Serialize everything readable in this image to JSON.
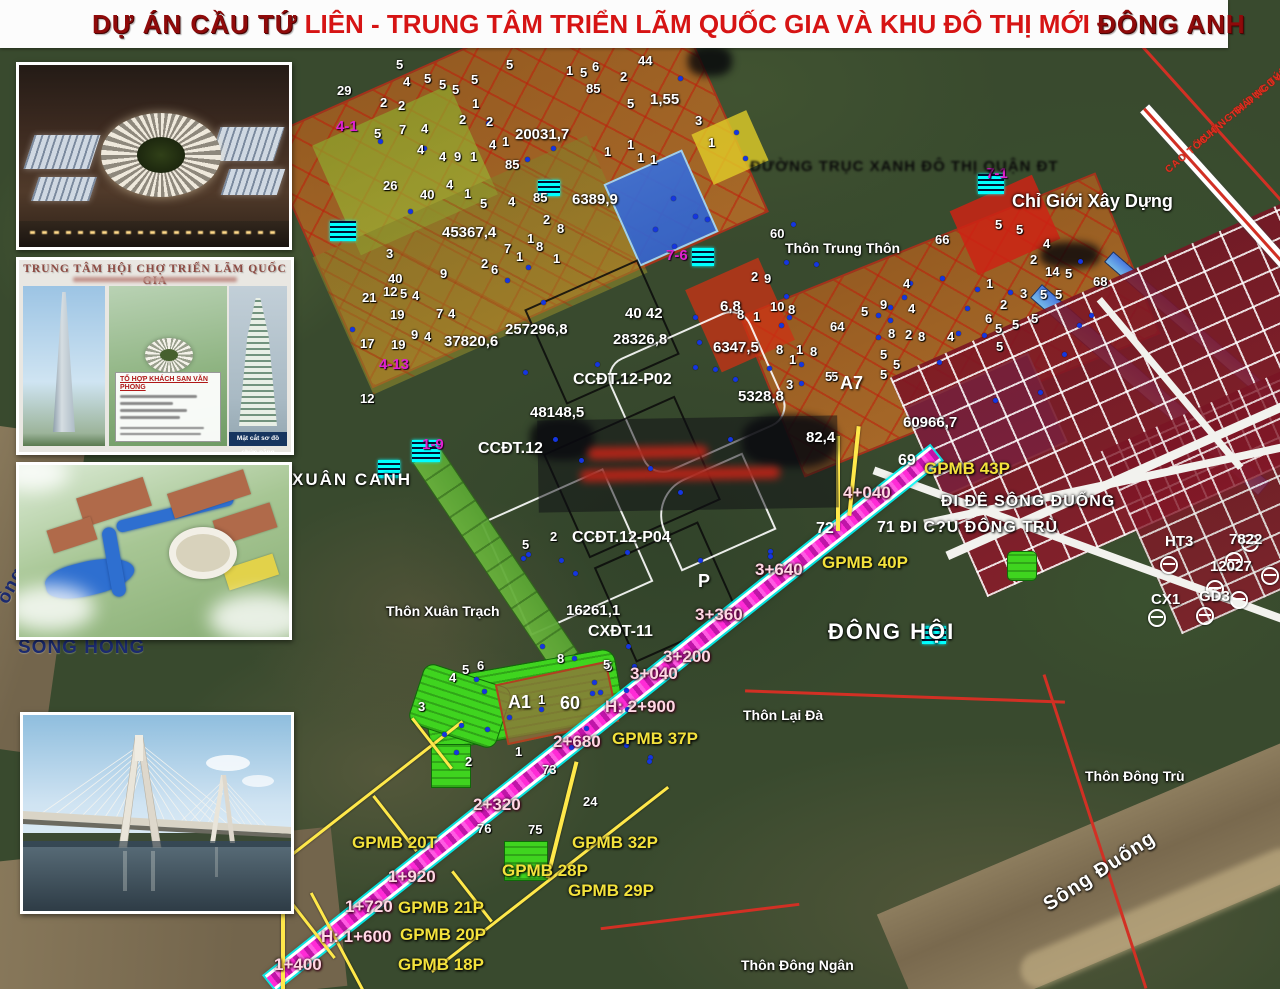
{
  "title": {
    "part1": "DỰ ÁN CẦU TỨ",
    "part2": " LIÊN - TRUNG TÂM TRIỂN LÃM QUỐC GIA VÀ KHU ĐÔ THỊ MỚI ",
    "part3": "ĐÔNG ANH"
  },
  "insets": {
    "exhibition_panel": {
      "header": "TRUNG TÂM HỘI CHỢ TRIỂN LÃM QUỐC GIA",
      "box_title": "TỔ HỢP KHÁCH SẠN VĂN PHÒNG",
      "section_caption": "Mặt cắt sơ đồ chức năng"
    }
  },
  "map": {
    "places": [
      {
        "t": "XUÂN CANH",
        "x": 292,
        "y": 471,
        "s": 17,
        "ls": 2
      },
      {
        "t": "Thôn Xuân Trạch",
        "x": 386,
        "y": 604
      },
      {
        "t": "Thôn Trung Thôn",
        "x": 785,
        "y": 241
      },
      {
        "t": "ĐÔNG HỘI",
        "x": 828,
        "y": 620,
        "s": 22,
        "ls": 2
      },
      {
        "t": "Thôn Lại Đà",
        "x": 743,
        "y": 708
      },
      {
        "t": "Thôn Đông Trù",
        "x": 1085,
        "y": 769
      },
      {
        "t": "Thôn Đông Ngân",
        "x": 741,
        "y": 958
      },
      {
        "t": "Chỉ Giới Xây Dựng",
        "x": 1012,
        "y": 192,
        "s": 18
      },
      {
        "t": "Sông Đuống",
        "x": 1040,
        "y": 898,
        "s": 20,
        "r": -33,
        "ls": 1
      }
    ],
    "river_labels": [
      {
        "t": "SÔNG HỒNG",
        "x": 18,
        "y": 638
      },
      {
        "t": "ồng",
        "x": -6,
        "y": 598,
        "r": -62
      }
    ],
    "gpmb": [
      {
        "t": "GPMB 43P",
        "x": 924,
        "y": 460
      },
      {
        "t": "GPMB 40P",
        "x": 822,
        "y": 554
      },
      {
        "t": "GPMB 37P",
        "x": 612,
        "y": 730
      },
      {
        "t": "GPMB 32P",
        "x": 572,
        "y": 834
      },
      {
        "t": "GPMB 28P",
        "x": 502,
        "y": 862
      },
      {
        "t": "GPMB 29P",
        "x": 568,
        "y": 882
      },
      {
        "t": "GPMB 20T",
        "x": 352,
        "y": 834
      },
      {
        "t": "GPMB 21P",
        "x": 398,
        "y": 899
      },
      {
        "t": "GPMB 20P",
        "x": 400,
        "y": 926
      },
      {
        "t": "GPMB 18P",
        "x": 398,
        "y": 956
      }
    ],
    "chainage": [
      {
        "t": "4+040",
        "x": 843,
        "y": 484
      },
      {
        "t": "3+640",
        "x": 755,
        "y": 561
      },
      {
        "t": "3+360",
        "x": 695,
        "y": 606
      },
      {
        "t": "3+200",
        "x": 663,
        "y": 648
      },
      {
        "t": "3+040",
        "x": 630,
        "y": 665
      },
      {
        "t": "H: 2+900",
        "x": 605,
        "y": 698
      },
      {
        "t": "2+680",
        "x": 553,
        "y": 733
      },
      {
        "t": "2+320",
        "x": 473,
        "y": 796
      },
      {
        "t": "1+920",
        "x": 388,
        "y": 868
      },
      {
        "t": "1+720",
        "x": 345,
        "y": 898
      },
      {
        "t": "H: 1+600",
        "x": 321,
        "y": 928
      },
      {
        "t": "1+400",
        "x": 274,
        "y": 956
      }
    ],
    "area_numbers": [
      {
        "t": "20031,7",
        "x": 515,
        "y": 127
      },
      {
        "t": "6389,9",
        "x": 572,
        "y": 192
      },
      {
        "t": "45367,4",
        "x": 442,
        "y": 225
      },
      {
        "t": "257296,8",
        "x": 505,
        "y": 322
      },
      {
        "t": "37820,6",
        "x": 444,
        "y": 334
      },
      {
        "t": "28326,8",
        "x": 613,
        "y": 332
      },
      {
        "t": "6347,5",
        "x": 713,
        "y": 340
      },
      {
        "t": "5328,8",
        "x": 738,
        "y": 389
      },
      {
        "t": "48148,5",
        "x": 530,
        "y": 405
      },
      {
        "t": "60966,7",
        "x": 903,
        "y": 415
      },
      {
        "t": "82,4",
        "x": 806,
        "y": 430
      },
      {
        "t": "16261,1",
        "x": 566,
        "y": 603
      },
      {
        "t": "1,55",
        "x": 650,
        "y": 92
      },
      {
        "t": "40 42",
        "x": 625,
        "y": 306
      },
      {
        "t": "6,8",
        "x": 720,
        "y": 299
      }
    ],
    "zone_codes": [
      {
        "t": "CCĐT.12-P02",
        "x": 573,
        "y": 372
      },
      {
        "t": "CCĐT.12-P04",
        "x": 572,
        "y": 530
      },
      {
        "t": "CXĐT-11",
        "x": 588,
        "y": 624
      },
      {
        "t": "CCĐT.12",
        "x": 478,
        "y": 441
      },
      {
        "t": "A7",
        "x": 840,
        "y": 374,
        "s": 18
      },
      {
        "t": "A1",
        "x": 508,
        "y": 693,
        "s": 18
      },
      {
        "t": "60",
        "x": 560,
        "y": 694,
        "s": 18
      },
      {
        "t": "P",
        "x": 698,
        "y": 572,
        "s": 18
      }
    ],
    "magenta_codes": [
      {
        "t": "4-1",
        "x": 336,
        "y": 119
      },
      {
        "t": "4-13",
        "x": 379,
        "y": 357
      },
      {
        "t": "1-9",
        "x": 422,
        "y": 437
      },
      {
        "t": "7-1",
        "x": 986,
        "y": 166
      },
      {
        "t": "7-6",
        "x": 666,
        "y": 248
      }
    ],
    "route_numbers": [
      {
        "t": "69",
        "x": 898,
        "y": 453
      },
      {
        "t": "72",
        "x": 816,
        "y": 521
      },
      {
        "t": "71",
        "x": 877,
        "y": 520
      }
    ],
    "road_white": [
      {
        "t": "ĐI ĐÊ SÔNG ĐUỐNG",
        "x": 941,
        "y": 494
      },
      {
        "t": "ĐI C?U ĐÔNG TRÙ",
        "x": 900,
        "y": 520
      }
    ],
    "road_black": [
      {
        "t": "ĐƯỜNG TRỤC XANH ĐÔ THỊ QUẬN ĐT",
        "x": 750,
        "y": 159
      }
    ],
    "red_route": [
      {
        "t": "HƯỚNG ĐI DỤC TÚ",
        "x": 1196,
        "y": 140,
        "r": -40
      },
      {
        "t": "CAO TỐC HN - THÁI NGUYÊN",
        "x": 1164,
        "y": 168,
        "r": -40
      }
    ],
    "survey": [
      {
        "t": "HT3",
        "x": 1165,
        "y": 534
      },
      {
        "t": "7822",
        "x": 1229,
        "y": 532
      },
      {
        "t": "12027",
        "x": 1210,
        "y": 559
      },
      {
        "t": "CX1",
        "x": 1151,
        "y": 592
      },
      {
        "t": "GD3",
        "x": 1199,
        "y": 589
      }
    ],
    "survey_markers": [
      [
        1160,
        556
      ],
      [
        1225,
        552
      ],
      [
        1206,
        580
      ],
      [
        1261,
        567
      ],
      [
        1230,
        591
      ],
      [
        1196,
        607
      ],
      [
        1148,
        609
      ],
      [
        1241,
        534
      ]
    ],
    "small_numbers": [
      [
        337,
        84,
        "29"
      ],
      [
        396,
        58,
        "5"
      ],
      [
        506,
        58,
        "5"
      ],
      [
        566,
        64,
        "1"
      ],
      [
        580,
        66,
        "5"
      ],
      [
        592,
        60,
        "6"
      ],
      [
        586,
        82,
        "85"
      ],
      [
        620,
        70,
        "2"
      ],
      [
        627,
        97,
        "5"
      ],
      [
        638,
        54,
        "44"
      ],
      [
        695,
        114,
        "3"
      ],
      [
        708,
        136,
        "1"
      ],
      [
        627,
        138,
        "1"
      ],
      [
        604,
        145,
        "1"
      ],
      [
        637,
        151,
        "1"
      ],
      [
        650,
        153,
        "1"
      ],
      [
        380,
        96,
        "2"
      ],
      [
        398,
        99,
        "2"
      ],
      [
        403,
        75,
        "4"
      ],
      [
        424,
        72,
        "5"
      ],
      [
        439,
        78,
        "5"
      ],
      [
        452,
        83,
        "5"
      ],
      [
        471,
        73,
        "5"
      ],
      [
        472,
        97,
        "1"
      ],
      [
        459,
        113,
        "2"
      ],
      [
        486,
        115,
        "2"
      ],
      [
        374,
        127,
        "5"
      ],
      [
        399,
        123,
        "7"
      ],
      [
        421,
        122,
        "4"
      ],
      [
        417,
        143,
        "4"
      ],
      [
        439,
        150,
        "4"
      ],
      [
        454,
        150,
        "9"
      ],
      [
        470,
        150,
        "1"
      ],
      [
        489,
        138,
        "4"
      ],
      [
        502,
        135,
        "1"
      ],
      [
        383,
        179,
        "26"
      ],
      [
        420,
        188,
        "40"
      ],
      [
        446,
        178,
        "4"
      ],
      [
        464,
        187,
        "1"
      ],
      [
        480,
        197,
        "5"
      ],
      [
        508,
        195,
        "4"
      ],
      [
        505,
        158,
        "85"
      ],
      [
        533,
        191,
        "85"
      ],
      [
        543,
        213,
        "2"
      ],
      [
        557,
        222,
        "8"
      ],
      [
        527,
        232,
        "1"
      ],
      [
        536,
        240,
        "8"
      ],
      [
        504,
        242,
        "7"
      ],
      [
        481,
        257,
        "2"
      ],
      [
        491,
        263,
        "6"
      ],
      [
        516,
        250,
        "1"
      ],
      [
        553,
        252,
        "1"
      ],
      [
        386,
        247,
        "3"
      ],
      [
        388,
        272,
        "40"
      ],
      [
        440,
        267,
        "9"
      ],
      [
        383,
        285,
        "12"
      ],
      [
        400,
        287,
        "5"
      ],
      [
        412,
        289,
        "4"
      ],
      [
        362,
        291,
        "21"
      ],
      [
        436,
        307,
        "7"
      ],
      [
        448,
        307,
        "4"
      ],
      [
        390,
        308,
        "19"
      ],
      [
        411,
        328,
        "9"
      ],
      [
        424,
        330,
        "4"
      ],
      [
        360,
        337,
        "17"
      ],
      [
        391,
        338,
        "19"
      ],
      [
        360,
        392,
        "12"
      ],
      [
        770,
        227,
        "60"
      ],
      [
        935,
        233,
        "66"
      ],
      [
        995,
        218,
        "5"
      ],
      [
        1016,
        223,
        "5"
      ],
      [
        1043,
        237,
        "4"
      ],
      [
        1030,
        253,
        "2"
      ],
      [
        1045,
        265,
        "14"
      ],
      [
        1065,
        267,
        "5"
      ],
      [
        1093,
        275,
        "68"
      ],
      [
        986,
        277,
        "1"
      ],
      [
        1020,
        287,
        "3"
      ],
      [
        1040,
        288,
        "5"
      ],
      [
        1000,
        298,
        "2"
      ],
      [
        995,
        322,
        "5"
      ],
      [
        903,
        277,
        "4"
      ],
      [
        880,
        298,
        "9"
      ],
      [
        861,
        305,
        "5"
      ],
      [
        908,
        302,
        "4"
      ],
      [
        830,
        320,
        "64"
      ],
      [
        888,
        327,
        "8"
      ],
      [
        905,
        328,
        "2"
      ],
      [
        918,
        330,
        "8"
      ],
      [
        947,
        330,
        "4"
      ],
      [
        985,
        312,
        "6"
      ],
      [
        1012,
        318,
        "5"
      ],
      [
        1031,
        312,
        "5"
      ],
      [
        1055,
        288,
        "5"
      ],
      [
        996,
        340,
        "5"
      ],
      [
        880,
        348,
        "5"
      ],
      [
        893,
        358,
        "5"
      ],
      [
        880,
        368,
        "5"
      ],
      [
        831,
        370,
        "5"
      ],
      [
        751,
        270,
        "2"
      ],
      [
        764,
        272,
        "9"
      ],
      [
        737,
        308,
        "8"
      ],
      [
        753,
        310,
        "1"
      ],
      [
        770,
        300,
        "10"
      ],
      [
        788,
        303,
        "8"
      ],
      [
        796,
        343,
        "1"
      ],
      [
        810,
        345,
        "8"
      ],
      [
        789,
        353,
        "1"
      ],
      [
        786,
        378,
        "3"
      ],
      [
        825,
        370,
        "5"
      ],
      [
        776,
        343,
        "8"
      ],
      [
        449,
        671,
        "4"
      ],
      [
        462,
        663,
        "5"
      ],
      [
        477,
        659,
        "6"
      ],
      [
        557,
        652,
        "8"
      ],
      [
        605,
        660,
        "5"
      ],
      [
        418,
        700,
        "3"
      ],
      [
        465,
        755,
        "2"
      ],
      [
        515,
        745,
        "1"
      ],
      [
        538,
        693,
        "1"
      ],
      [
        542,
        763,
        "73"
      ],
      [
        583,
        795,
        "24"
      ],
      [
        477,
        822,
        "76"
      ],
      [
        528,
        823,
        "75"
      ],
      [
        550,
        530,
        "2"
      ],
      [
        522,
        538,
        "5"
      ],
      [
        603,
        658,
        "5"
      ]
    ]
  },
  "colors": {
    "title_dark_red": "#8f0a0a",
    "title_bright_red": "#d61414",
    "gpmb_yellow": "#f3e23c",
    "alignment_magenta": "#ff2bd6",
    "corridor_green": "#69b23c",
    "urban_red": "#8b1a2a",
    "canal_blue": "#4a7ae0",
    "river_label_navy": "#1b2a6e"
  }
}
